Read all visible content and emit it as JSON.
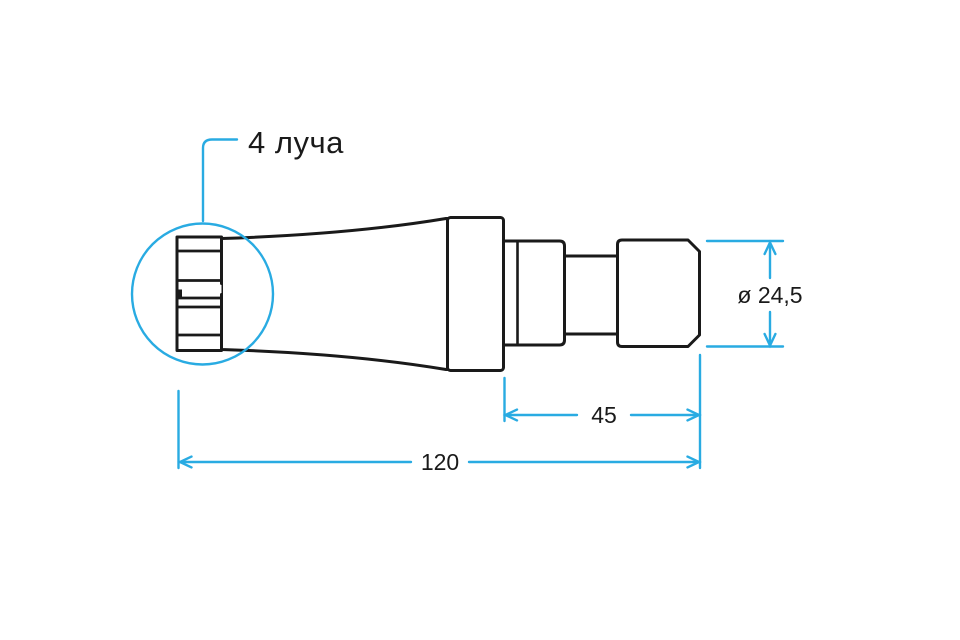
{
  "diagram": {
    "type": "technical-drawing",
    "callout_label": "4 луча",
    "dim_diameter": "ø 24,5",
    "dim_mid_length": "45",
    "dim_total_length": "120",
    "colors": {
      "accent": "#29abe2",
      "line": "#1a1a1a",
      "background": "#ffffff"
    }
  }
}
